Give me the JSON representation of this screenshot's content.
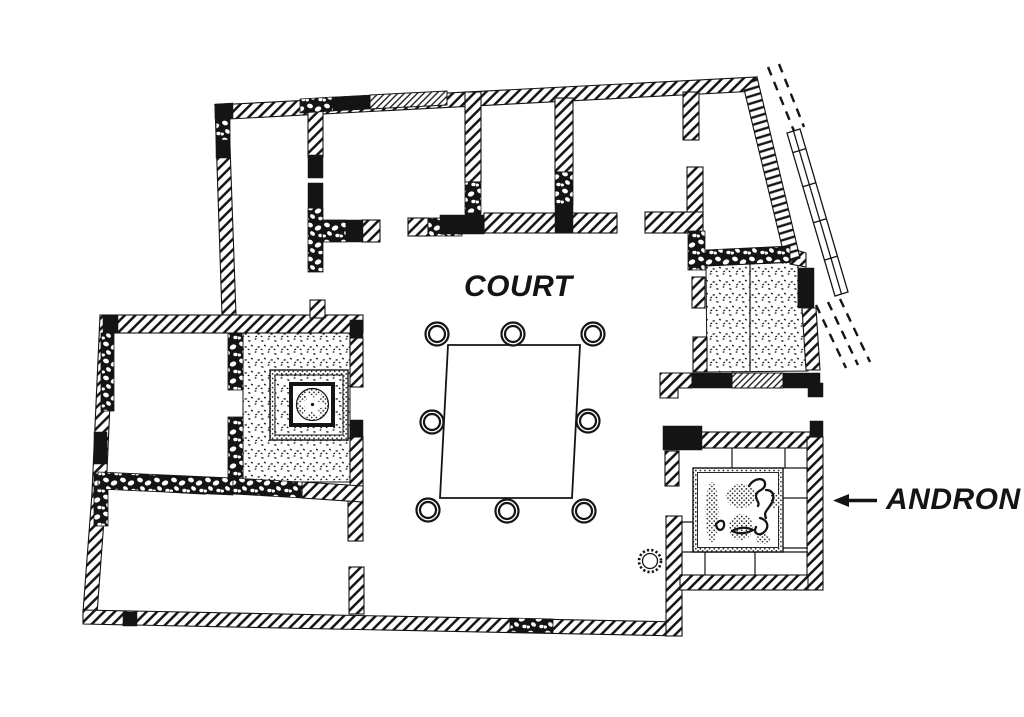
{
  "labels": {
    "court": "COURT",
    "andron": "ANDRON"
  },
  "annotation_arrow": {
    "icon": "left-arrow-icon",
    "direction": "left",
    "points_to": "andron room"
  },
  "colors": {
    "ink": "#141414",
    "paper": "#ffffff"
  },
  "plan": {
    "column_base_count": 8,
    "column_bases": [
      {
        "x": 437,
        "y": 334
      },
      {
        "x": 513,
        "y": 334
      },
      {
        "x": 593,
        "y": 334
      },
      {
        "x": 432,
        "y": 422
      },
      {
        "x": 588,
        "y": 421
      },
      {
        "x": 428,
        "y": 510
      },
      {
        "x": 507,
        "y": 511
      },
      {
        "x": 584,
        "y": 511
      }
    ],
    "well": {
      "x": 650,
      "y": 561,
      "r": 11
    },
    "court_altar_outline": [
      [
        448,
        345
      ],
      [
        580,
        345
      ],
      [
        572,
        498
      ],
      [
        440,
        498
      ]
    ]
  }
}
